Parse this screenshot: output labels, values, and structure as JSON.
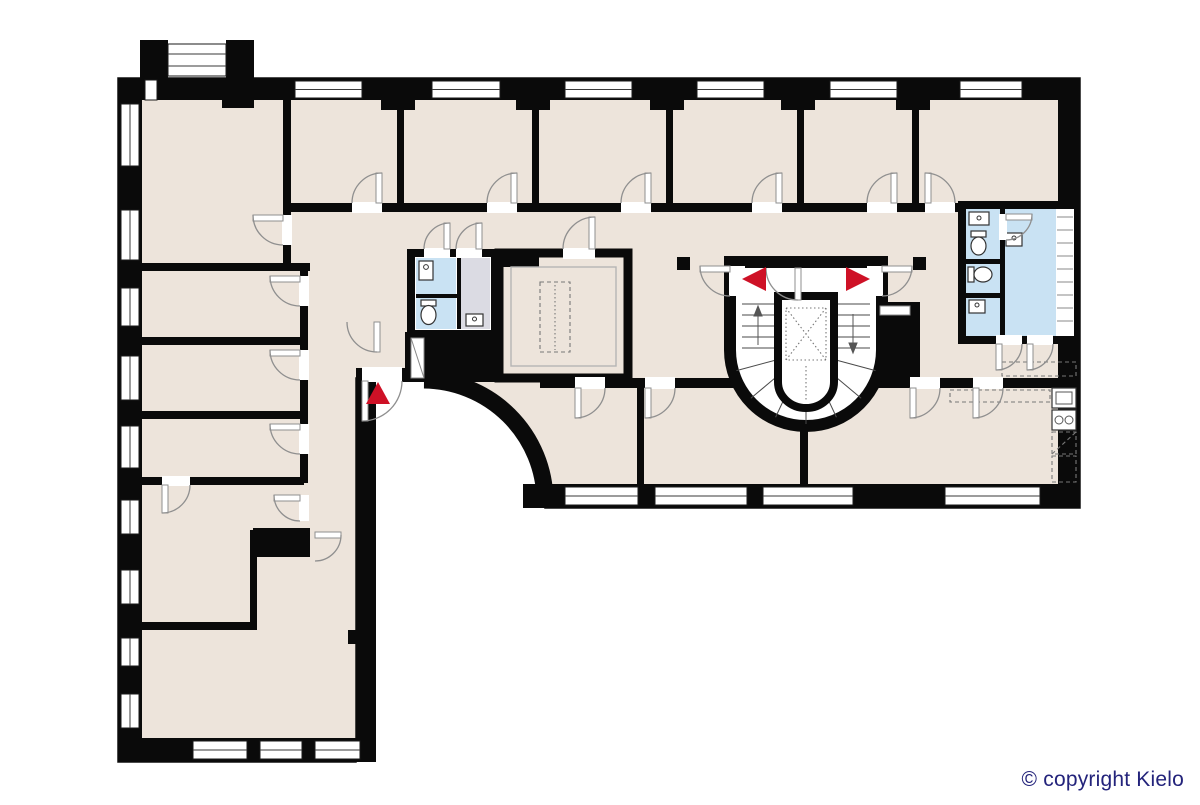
{
  "page": {
    "background": "#ffffff"
  },
  "plan": {
    "type": "building-floor-plan",
    "palette": {
      "floor": "#EDE4DB",
      "wall": "#0A0A0A",
      "wet": "#C9E2F3",
      "utility": "#DBDBE3",
      "exit": "#CE1126",
      "arc": "#8F8F8F",
      "copyright": "#23237B"
    },
    "icons": [
      "window-icon",
      "door-arc-icon",
      "exit-arrow-icon",
      "stair-treads-icon",
      "elevator-shaft-icon",
      "toilet-icon",
      "sink-icon",
      "stove-icon",
      "counter-icon",
      "column-icon",
      "shelf-stripes-icon"
    ],
    "exit_arrow_count": 3
  },
  "footer": {
    "copyright": "© copyright Kielo"
  }
}
